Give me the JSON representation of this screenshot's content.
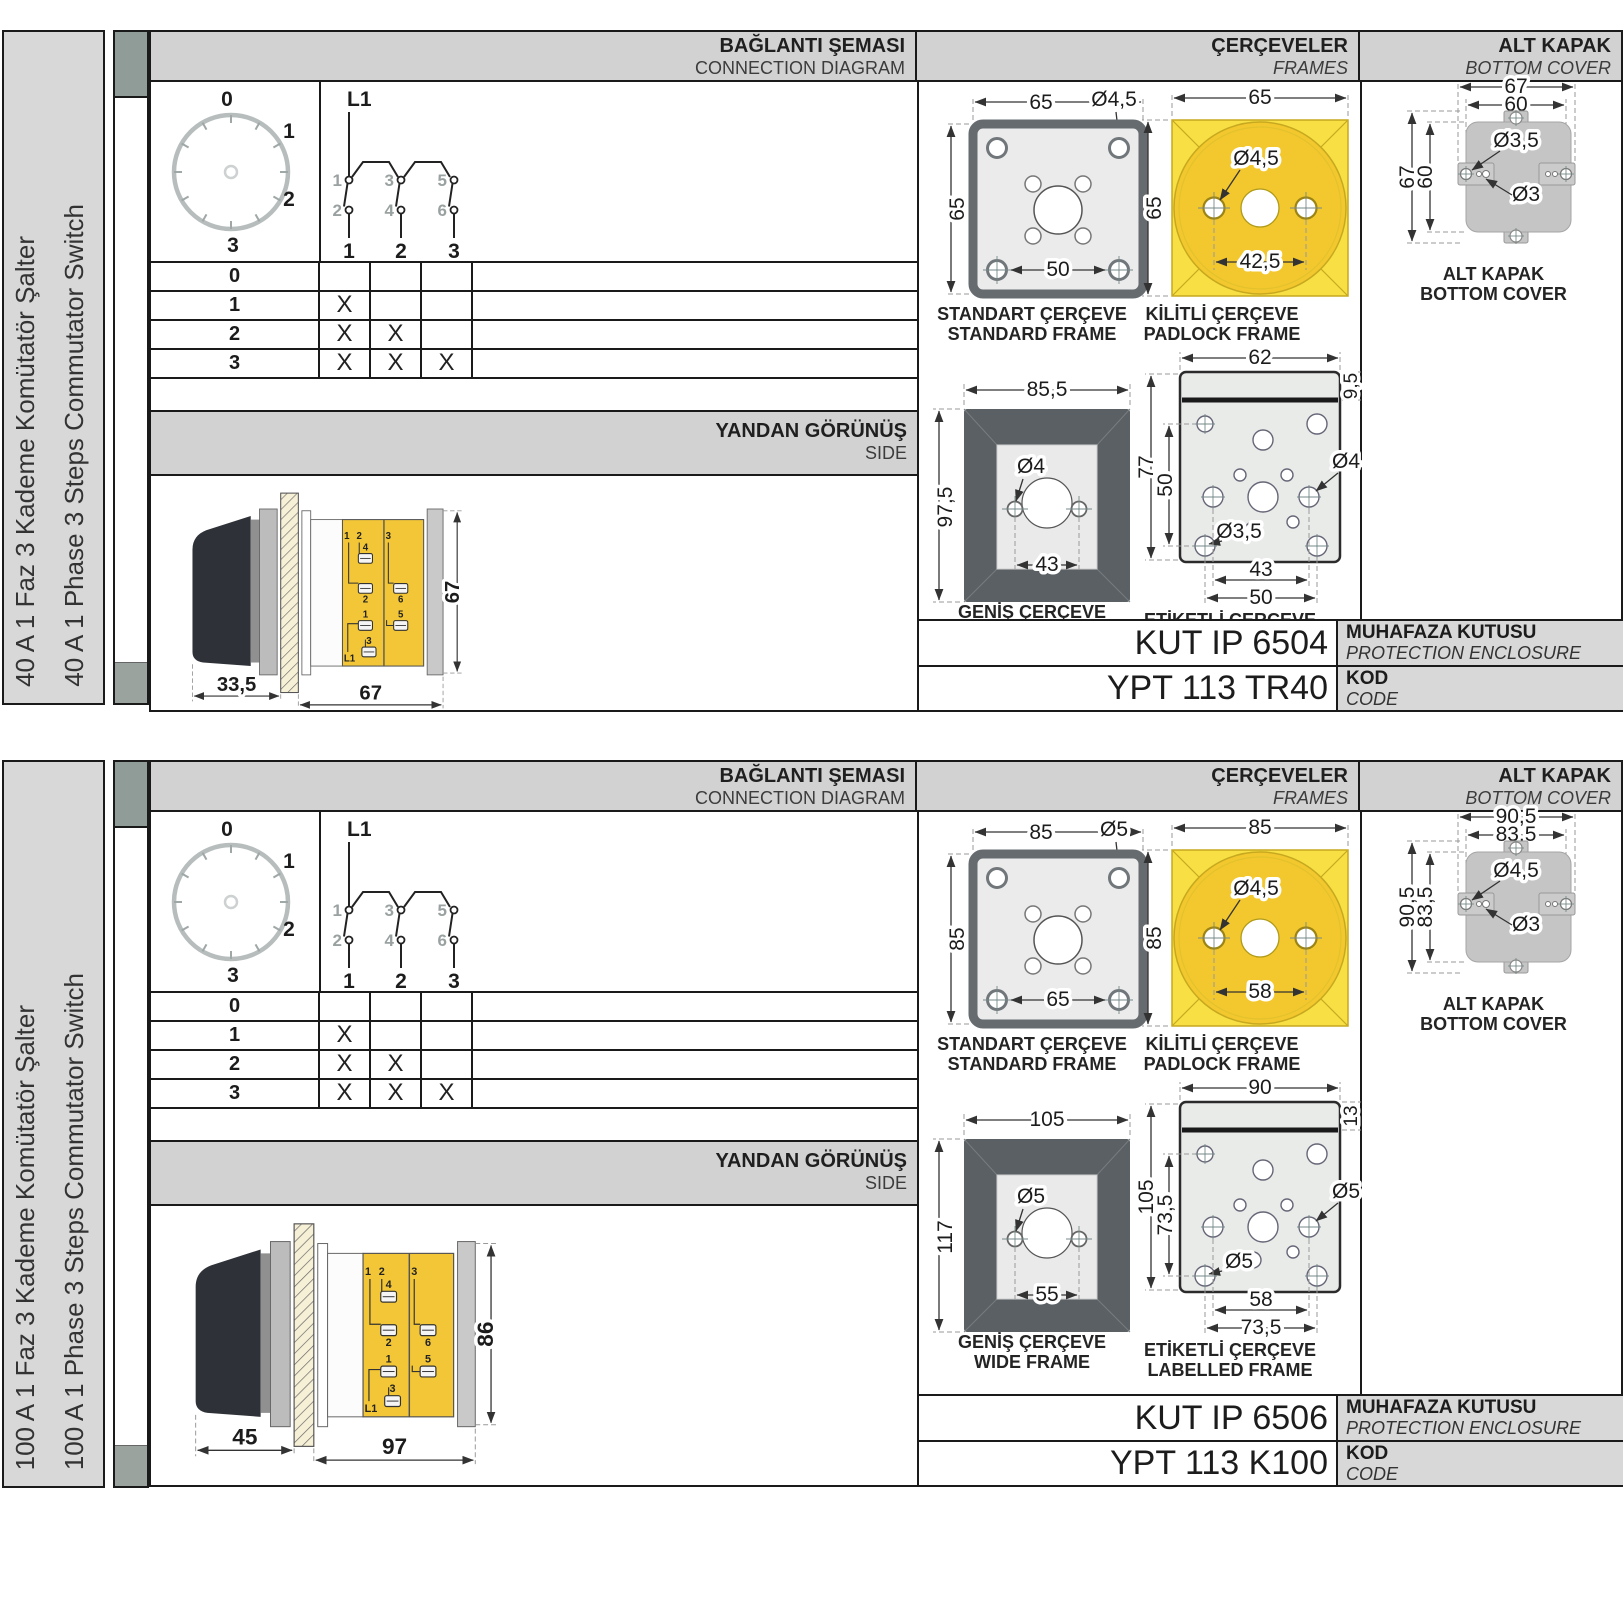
{
  "sections": [
    {
      "sidebar": {
        "tr": "40 A 1 Faz 3 Kademe Komütatör Şalter",
        "en": "40 A 1 Phase 3 Steps Commutator Switch"
      },
      "headers": {
        "connection": {
          "tr": "BAĞLANTI ŞEMASI",
          "en": "CONNECTION DIAGRAM"
        },
        "frames": {
          "tr": "ÇERÇEVELER",
          "en": "FRAMES"
        },
        "cover": {
          "tr": "ALT KAPAK",
          "en": "BOTTOM COVER"
        }
      },
      "dial": {
        "positions": [
          "0",
          "1",
          "2",
          "3"
        ]
      },
      "schematic": {
        "feed": "L1",
        "top_contacts": [
          "1",
          "3",
          "5"
        ],
        "bottom_contacts": [
          "2",
          "4",
          "6"
        ],
        "poles": [
          "1",
          "2",
          "3"
        ]
      },
      "truth_table": {
        "rows": [
          {
            "label": "0",
            "marks": [
              "",
              "",
              ""
            ]
          },
          {
            "label": "1",
            "marks": [
              "X",
              "",
              ""
            ]
          },
          {
            "label": "2",
            "marks": [
              "X",
              "X",
              ""
            ]
          },
          {
            "label": "3",
            "marks": [
              "X",
              "X",
              "X"
            ]
          }
        ]
      },
      "side_view": {
        "title": {
          "tr": "YANDAN GÖRÜNÜŞ",
          "en": "SIDE"
        },
        "dims": {
          "handle_depth": "33,5",
          "body_depth": "67",
          "height": "67"
        },
        "terminals": [
          "1",
          "2",
          "4",
          "2",
          "3",
          "6",
          "1",
          "5",
          "3",
          "L1"
        ]
      },
      "frames": {
        "standard": {
          "caption": {
            "tr": "STANDART ÇERÇEVE",
            "en": "STANDARD FRAME"
          },
          "dims": {
            "width": "65",
            "height": "65",
            "hole_dia": "Ø4,5",
            "hole_span": "50"
          }
        },
        "padlock": {
          "caption": {
            "tr": "KİLİTLİ ÇERÇEVE",
            "en": "PADLOCK FRAME"
          },
          "dims": {
            "width": "65",
            "height": "65",
            "hole_dia": "Ø4,5",
            "hole_span": "42,5"
          }
        },
        "wide": {
          "caption": {
            "tr": "GENİŞ ÇERÇEVE",
            "en": "WIDE FRAME"
          },
          "dims": {
            "width": "85,5",
            "height": "97,5",
            "hole_dia": "Ø4",
            "hole_span": "43"
          }
        },
        "labelled": {
          "caption": {
            "tr": "ETİKETLİ ÇERÇEVE",
            "en": "LABELLED FRAME"
          },
          "dims": {
            "width": "62",
            "strip": "9,5",
            "height": "77",
            "inner_height": "50",
            "hole_dia_side": "Ø4",
            "hole_dia_small": "Ø3,5",
            "span_inner": "43",
            "span_outer": "50"
          }
        }
      },
      "cover": {
        "caption": {
          "tr": "ALT KAPAK",
          "en": "BOTTOM COVER"
        },
        "dims": {
          "outer_w": "67",
          "inner_w": "60",
          "outer_h": "67",
          "inner_h": "60",
          "hole_large": "Ø3,5",
          "hole_small": "Ø3"
        }
      },
      "codes": {
        "enclosure": {
          "value": "KUT IP 6504",
          "tr": "MUHAFAZA KUTUSU",
          "en": "PROTECTION ENCLOSURE"
        },
        "product": {
          "value": "YPT 113 TR40",
          "tr": "KOD",
          "en": "CODE"
        }
      }
    },
    {
      "sidebar": {
        "tr": "100 A 1 Faz 3 Kademe Komütatör Şalter",
        "en": "100 A 1 Phase 3 Steps Commutator Switch"
      },
      "headers": {
        "connection": {
          "tr": "BAĞLANTI ŞEMASI",
          "en": "CONNECTION DIAGRAM"
        },
        "frames": {
          "tr": "ÇERÇEVELER",
          "en": "FRAMES"
        },
        "cover": {
          "tr": "ALT KAPAK",
          "en": "BOTTOM COVER"
        }
      },
      "dial": {
        "positions": [
          "0",
          "1",
          "2",
          "3"
        ]
      },
      "schematic": {
        "feed": "L1",
        "top_contacts": [
          "1",
          "3",
          "5"
        ],
        "bottom_contacts": [
          "2",
          "4",
          "6"
        ],
        "poles": [
          "1",
          "2",
          "3"
        ]
      },
      "truth_table": {
        "rows": [
          {
            "label": "0",
            "marks": [
              "",
              "",
              ""
            ]
          },
          {
            "label": "1",
            "marks": [
              "X",
              "",
              ""
            ]
          },
          {
            "label": "2",
            "marks": [
              "X",
              "X",
              ""
            ]
          },
          {
            "label": "3",
            "marks": [
              "X",
              "X",
              "X"
            ]
          }
        ]
      },
      "side_view": {
        "title": {
          "tr": "YANDAN GÖRÜNÜŞ",
          "en": "SIDE"
        },
        "dims": {
          "handle_depth": "45",
          "body_depth": "97",
          "height": "86"
        },
        "terminals": [
          "1",
          "2",
          "4",
          "2",
          "3",
          "6",
          "1",
          "5",
          "3",
          "L1"
        ]
      },
      "frames": {
        "standard": {
          "caption": {
            "tr": "STANDART ÇERÇEVE",
            "en": "STANDARD FRAME"
          },
          "dims": {
            "width": "85",
            "height": "85",
            "hole_dia": "Ø5",
            "hole_span": "65"
          }
        },
        "padlock": {
          "caption": {
            "tr": "KİLİTLİ ÇERÇEVE",
            "en": "PADLOCK FRAME"
          },
          "dims": {
            "width": "85",
            "height": "85",
            "hole_dia": "Ø4,5",
            "hole_span": "58"
          }
        },
        "wide": {
          "caption": {
            "tr": "GENİŞ ÇERÇEVE",
            "en": "WIDE FRAME"
          },
          "dims": {
            "width": "105",
            "height": "117",
            "hole_dia": "Ø5",
            "hole_span": "55"
          }
        },
        "labelled": {
          "caption": {
            "tr": "ETİKETLİ ÇERÇEVE",
            "en": "LABELLED FRAME"
          },
          "dims": {
            "width": "90",
            "strip": "13",
            "height": "105",
            "inner_height": "73,5",
            "hole_dia_side": "Ø5",
            "hole_dia_small": "Ø5",
            "span_inner": "58",
            "span_outer": "73,5"
          }
        }
      },
      "cover": {
        "caption": {
          "tr": "ALT KAPAK",
          "en": "BOTTOM COVER"
        },
        "dims": {
          "outer_w": "90,5",
          "inner_w": "83,5",
          "outer_h": "90,5",
          "inner_h": "83,5",
          "hole_large": "Ø4,5",
          "hole_small": "Ø3"
        }
      },
      "codes": {
        "enclosure": {
          "value": "KUT IP 6506",
          "tr": "MUHAFAZA KUTUSU",
          "en": "PROTECTION ENCLOSURE"
        },
        "product": {
          "value": "YPT 113 K100",
          "tr": "KOD",
          "en": "CODE"
        }
      }
    }
  ]
}
